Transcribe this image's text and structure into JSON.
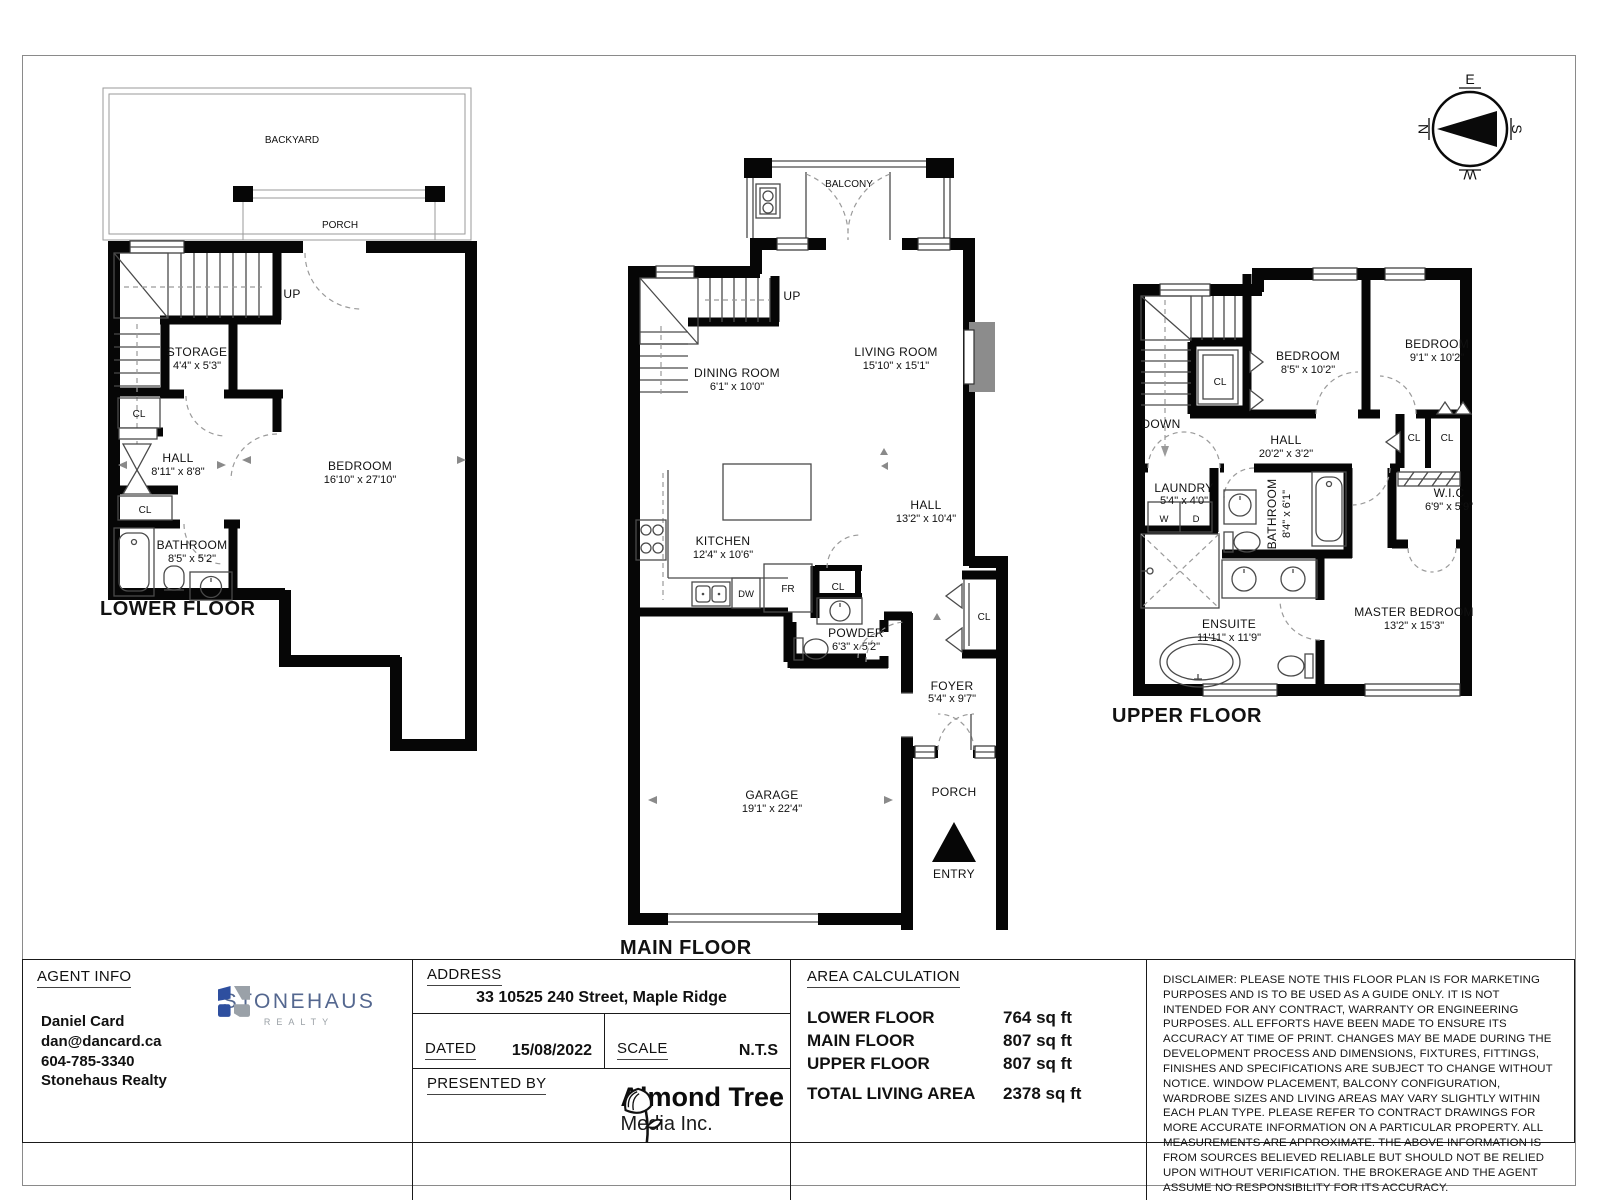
{
  "compass": {
    "n": "N",
    "e": "E",
    "s": "S",
    "w": "W"
  },
  "floors": {
    "lower": {
      "title": "LOWER FLOOR",
      "backyard": "BACKYARD",
      "porch": "PORCH",
      "up": "UP",
      "storage": "STORAGE",
      "storage_d": "4'4\" x 5'3\"",
      "cl_a": "CL",
      "cl_b": "CL",
      "hall": "HALL",
      "hall_d": "8'11\" x 8'8\"",
      "bathroom": "BATHROOM",
      "bathroom_d": "8'5\" x 5'2\"",
      "bedroom": "BEDROOM",
      "bedroom_d": "16'10\" x 27'10\""
    },
    "main": {
      "title": "MAIN FLOOR",
      "balcony": "BALCONY",
      "up": "UP",
      "dining": "DINING ROOM",
      "dining_d": "6'1\" x 10'0\"",
      "living": "LIVING ROOM",
      "living_d": "15'10\" x 15'1\"",
      "kitchen": "KITCHEN",
      "kitchen_d": "12'4\" x 10'6\"",
      "hall": "HALL",
      "hall_d": "13'2\" x 10'4\"",
      "dw": "DW",
      "fr": "FR",
      "cl_a": "CL",
      "cl_b": "CL",
      "powder": "POWDER",
      "powder_d": "6'3\" x 5'2\"",
      "foyer": "FOYER",
      "foyer_d": "5'4\" x 9'7\"",
      "garage": "GARAGE",
      "garage_d": "19'1\" x 22'4\"",
      "porch": "PORCH",
      "entry": "ENTRY"
    },
    "upper": {
      "title": "UPPER FLOOR",
      "down": "DOWN",
      "cl_stairs": "CL",
      "bedroom1": "BEDROOM",
      "bedroom1_d": "8'5\" x 10'2\"",
      "bedroom2": "BEDROOM",
      "bedroom2_d": "9'1\" x 10'2\"",
      "hall": "HALL",
      "hall_d": "20'2\" x 3'2\"",
      "cl_a": "CL",
      "cl_b": "CL",
      "laundry": "LAUNDRY",
      "laundry_d": "5'4\" x 4'0\"",
      "w": "W",
      "d": "D",
      "bathroom": "BATHROOM",
      "bathroom_d": "8'4\" x 6'1\"",
      "wic": "W.I.C",
      "wic_d": "6'9\" x 5'9\"",
      "ensuite": "ENSUITE",
      "ensuite_d": "11'11\" x 11'9\"",
      "master": "MASTER BEDROOM",
      "master_d": "13'2\" x 15'3\""
    }
  },
  "footer": {
    "agent": {
      "heading": "AGENT INFO",
      "name": "Daniel Card",
      "email": "dan@dancard.ca",
      "phone": "604-785-3340",
      "company": "Stonehaus Realty"
    },
    "stonehaus": {
      "name": "STONEHAUS",
      "tagline": "REALTY"
    },
    "address": {
      "heading": "ADDRESS",
      "value": "33 10525 240 Street, Maple Ridge"
    },
    "dated": {
      "label": "DATED",
      "value": "15/08/2022"
    },
    "scale": {
      "label": "SCALE",
      "value": "N.T.S"
    },
    "presented": {
      "label": "PRESENTED BY"
    },
    "media": {
      "name": "Almond Tree",
      "sub": "Media Inc."
    },
    "area": {
      "heading": "AREA CALCULATION",
      "rows": [
        {
          "label": "LOWER FLOOR",
          "value": "764 sq ft"
        },
        {
          "label": "MAIN FLOOR",
          "value": "807 sq ft"
        },
        {
          "label": "UPPER FLOOR",
          "value": "807 sq ft"
        }
      ],
      "total_label": "TOTAL LIVING AREA",
      "total_value": "2378 sq ft"
    },
    "disclaimer": "DISCLAIMER: PLEASE NOTE THIS FLOOR PLAN IS FOR MARKETING PURPOSES AND IS TO BE USED AS A GUIDE ONLY. IT IS NOT INTENDED FOR ANY CONTRACT, WARRANTY OR ENGINEERING PURPOSES. ALL EFFORTS HAVE BEEN MADE TO ENSURE ITS ACCURACY AT TIME OF PRINT. CHANGES MAY BE MADE DURING THE DEVELOPMENT PROCESS AND DIMENSIONS, FIXTURES, FITTINGS, FINISHES AND SPECIFICATIONS ARE SUBJECT TO CHANGE WITHOUT NOTICE. WINDOW PLACEMENT, BALCONY CONFIGURATION, WARDROBE SIZES AND LIVING AREAS MAY VARY SLIGHTLY WITHIN EACH PLAN TYPE. PLEASE REFER TO CONTRACT DRAWINGS FOR MORE ACCURATE INFORMATION ON A PARTICULAR PROPERTY. ALL MEASUREMENTS ARE APPROXIMATE. THE ABOVE INFORMATION IS FROM SOURCES BELIEVED RELIABLE BUT SHOULD NOT BE RELIED UPON WITHOUT VERIFICATION. THE BROKERAGE AND THE AGENT ASSUME NO RESPONSIBILITY FOR ITS ACCURACY."
  }
}
